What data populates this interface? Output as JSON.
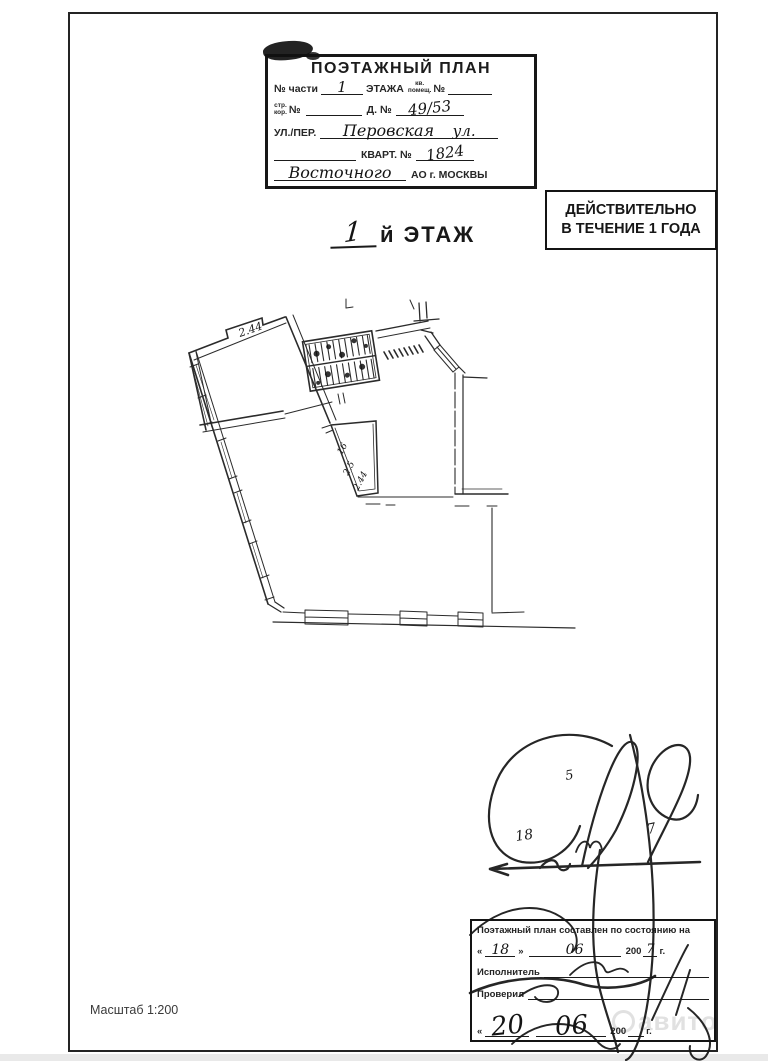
{
  "doc": {
    "header_box": {
      "title": "ПОЭТАЖНЫЙ ПЛАН",
      "row1": {
        "no_chasti": "№ части",
        "value_part": "1",
        "etazha": "ЭТАЖА",
        "kv": "кв.",
        "pomesh": "помещ.",
        "no": "№"
      },
      "row2": {
        "str": "стр.",
        "kor": "кор.",
        "no": "№",
        "d_no": "Д. №",
        "house_value": "49/53"
      },
      "row3": {
        "label": "УЛ./ПЕР.",
        "street_value": "Перовская",
        "street_suffix": "ул."
      },
      "row4": {
        "label": "КВАРТ. №",
        "kvartal_value": "1824"
      },
      "row5": {
        "okrug_value": "Восточного",
        "label": "АО г. МОСКВЫ"
      }
    },
    "stamp": {
      "line1": "ДЕЙСТВИТЕЛЬНО",
      "line2": "В ТЕЧЕНИЕ 1 ГОДА"
    },
    "floor_title": {
      "number": "1",
      "suffix": "й ЭТАЖ"
    },
    "plan_labels": {
      "dim_top": "2.44",
      "dim_a": "16",
      "dim_b": "2.5",
      "dim_c": "2.44"
    },
    "signature_area": {
      "n5": "5",
      "n18": "18",
      "n7": "7"
    },
    "footer_box": {
      "title": "Поэтажный план составлен по состоянию на",
      "date1": {
        "open": "«",
        "day": "18",
        "close": "»",
        "month": "06",
        "year_prefix": "200",
        "year_suffix": "7",
        "g": "г."
      },
      "executor_label": "Исполнитель",
      "checked_label": "Проверил",
      "date2": {
        "open": "«",
        "day": "20",
        "close": "»",
        "month": "06",
        "year_prefix": "200",
        "g": "г."
      }
    },
    "scale_label": "Масштаб 1:200",
    "watermark": "авито"
  }
}
